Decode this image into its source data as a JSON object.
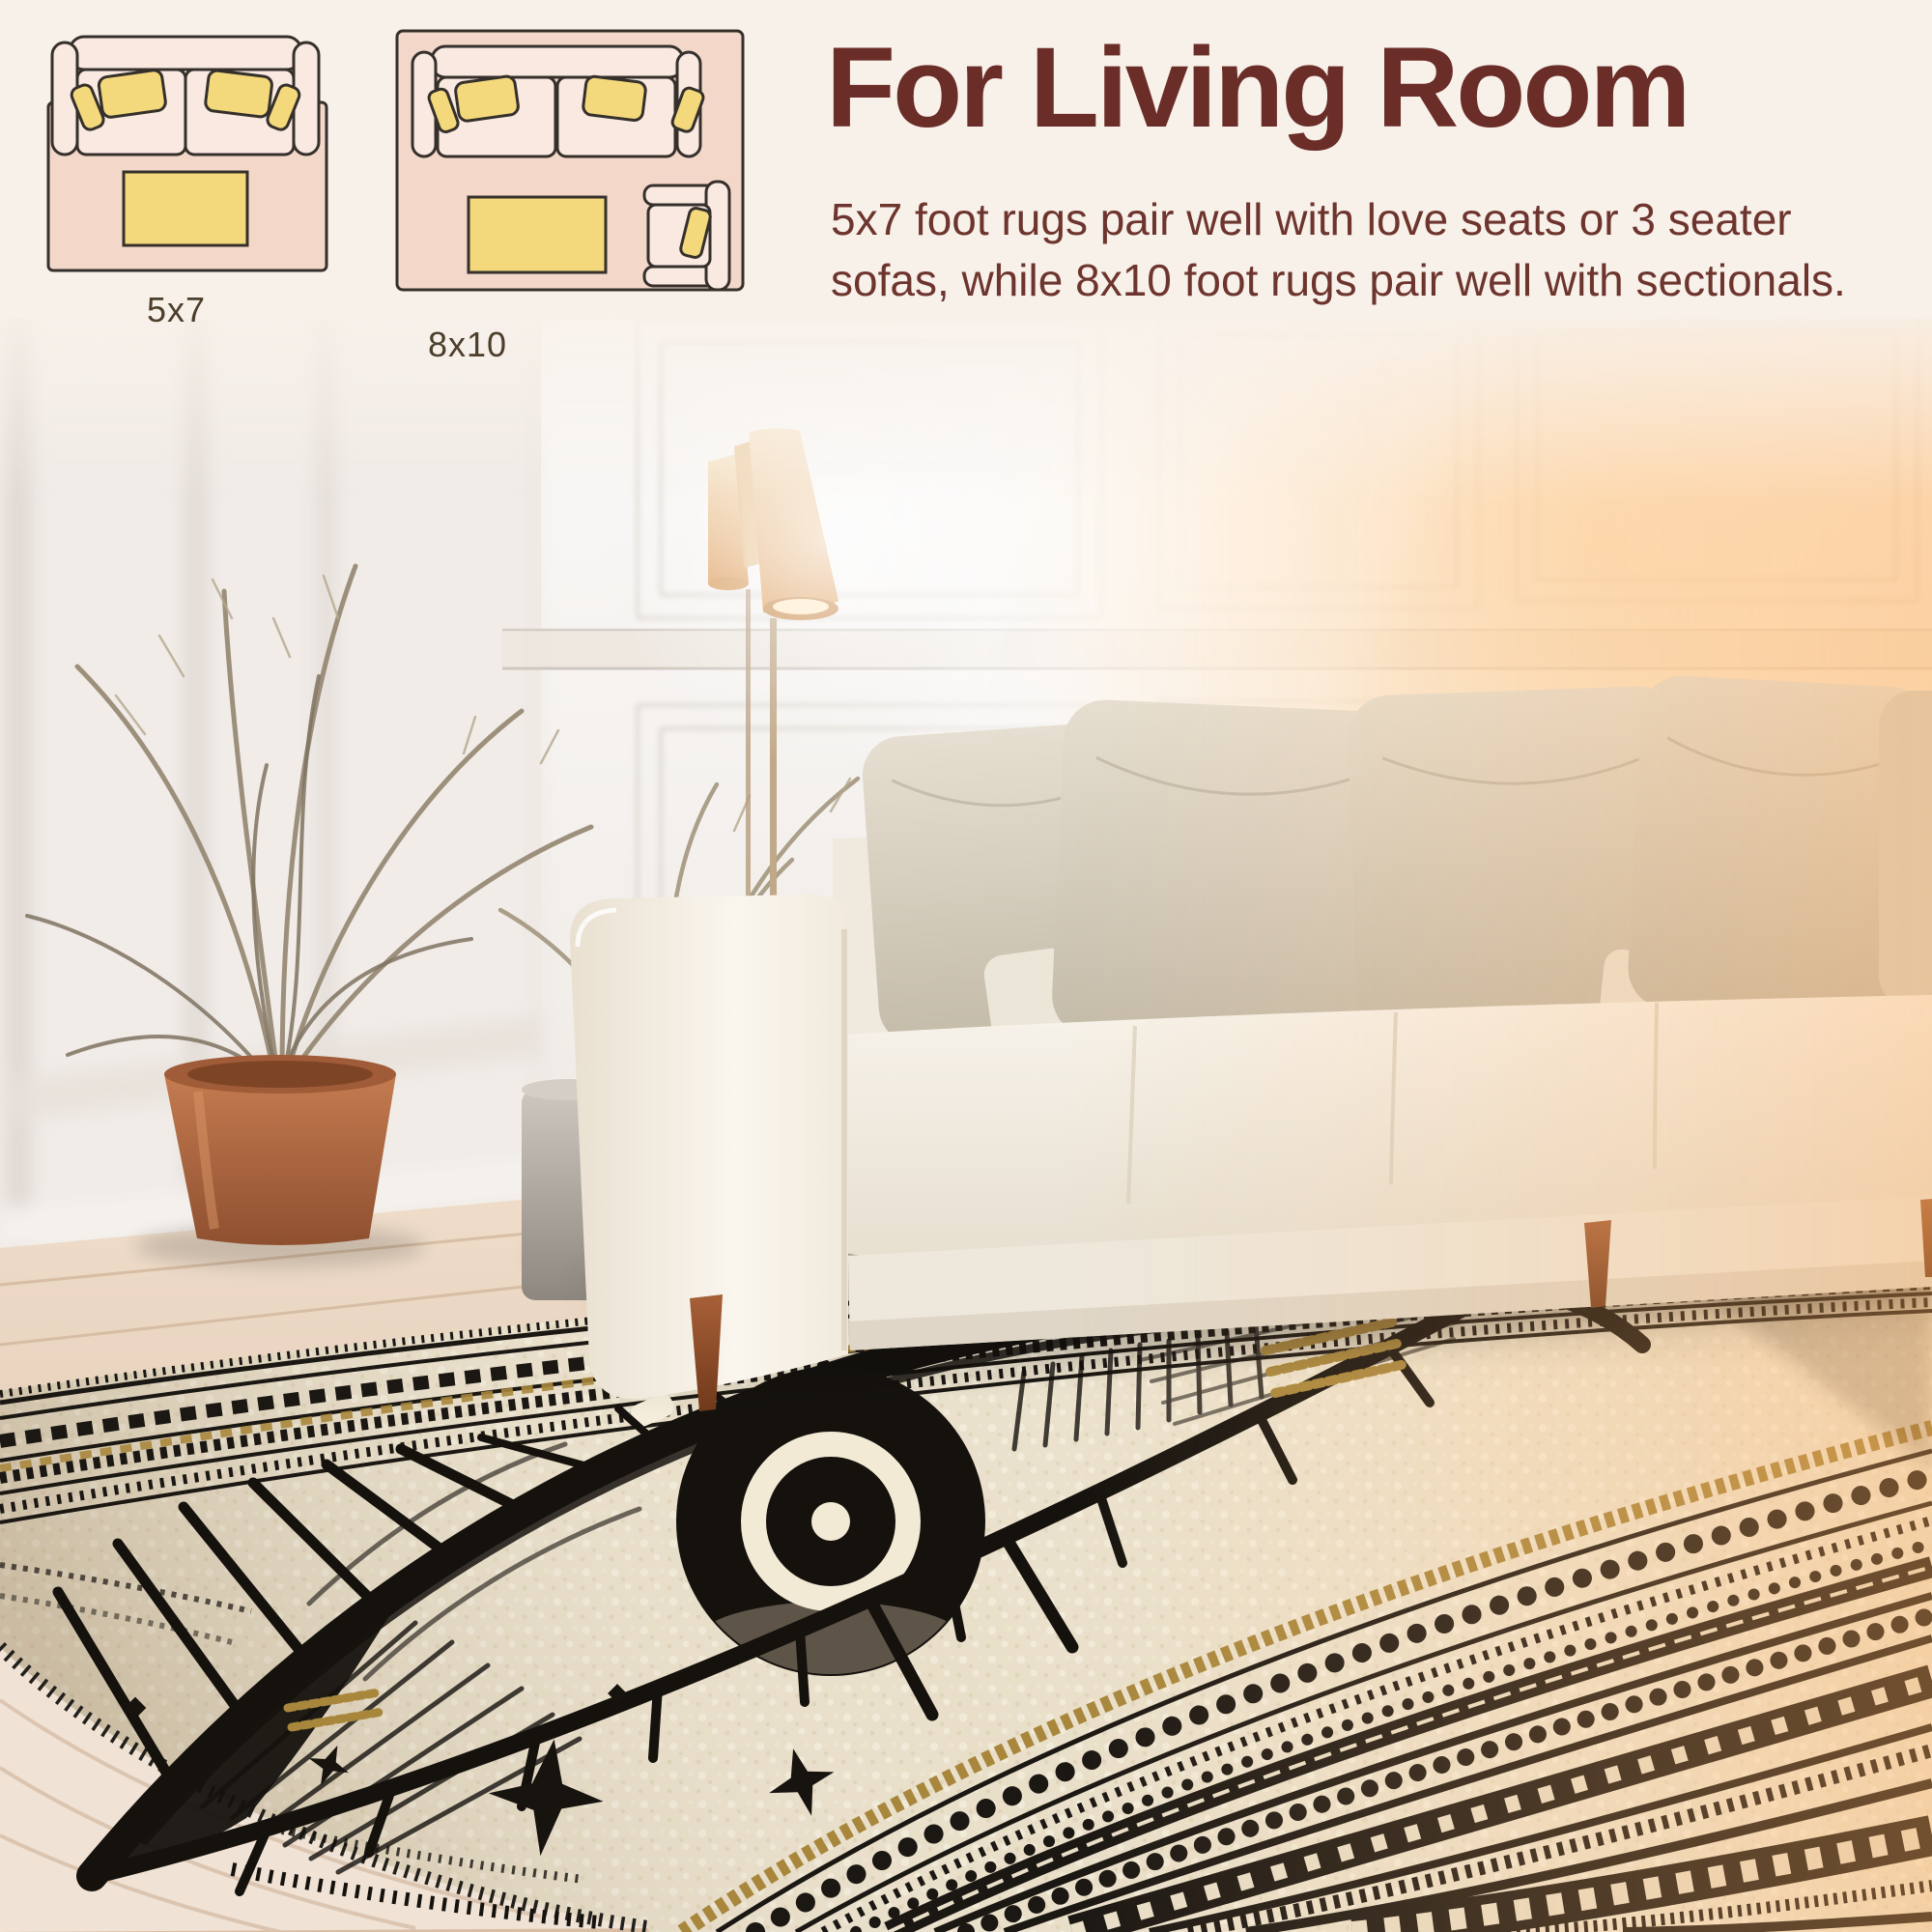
{
  "header": {
    "title": "For Living Room",
    "description": "5x7 foot rugs pair well with love seats or 3 seater sofas, while 8x10 foot rugs pair well with sectionals."
  },
  "size_diagrams": [
    {
      "label": "5x7",
      "items": [
        "loveseat",
        "throw-pillows",
        "coffee-table",
        "rug"
      ]
    },
    {
      "label": "8x10",
      "items": [
        "sofa",
        "throw-pillows",
        "coffee-table",
        "armchair",
        "rug"
      ]
    }
  ],
  "palette": {
    "title_color": "#6b2d28",
    "body_color": "#6d352e",
    "label_color": "#4c3e2b",
    "header_background": "#f8f1ea",
    "diagram_rug_pink": "#f3d8ca",
    "diagram_furniture_cream": "#f9e9e0",
    "diagram_accent_yellow": "#f4d97c",
    "diagram_outline": "#35302b",
    "rug_base_ivory": "#e9dfc9",
    "rug_ink_black": "#17130e",
    "rug_gold": "#a8873d",
    "sofa_cream": "#f4efe5",
    "pot_terracotta": "#b96f49",
    "wood_floor_light": "#ead6c2",
    "wood_floor_dark": "#6b3a1e",
    "window_glow": "#ffd9a8"
  },
  "scene": {
    "motif": "evil-eye-area-rug",
    "objects": [
      "paneled-wall",
      "floor-lamp",
      "dried-palm-plant",
      "terracotta-pot",
      "book-stack",
      "leaning-frames",
      "vase",
      "drum-side-table",
      "white-sofa",
      "throw-pillows",
      "evil-eye-area-rug",
      "wood-floor"
    ]
  }
}
